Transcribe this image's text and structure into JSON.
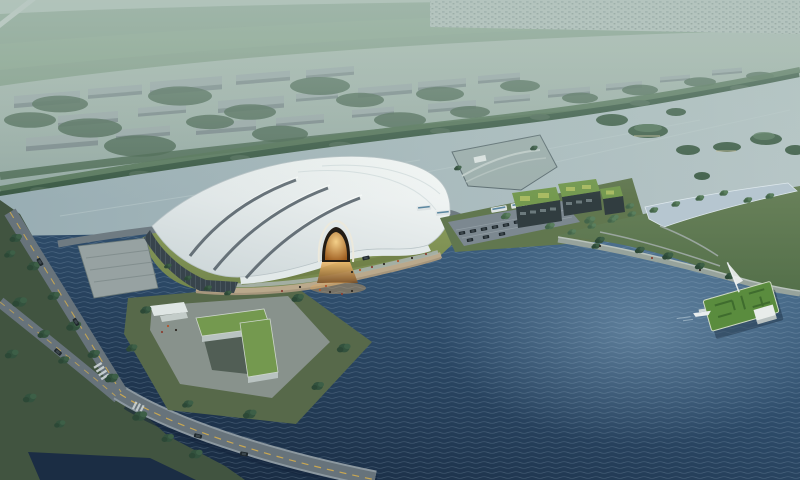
{
  "meta": {
    "kind": "architectural-aerial-rendering",
    "width": 800,
    "height": 480
  },
  "scene": {
    "description": "Aerial dusk rendering of a white membrane-roofed arena on a lakeside lawn island, with amber arched entrance, waterfront promenade, green-roof office cubes, parking lot, tree-lined boulevards with a bridge, a park peninsula with lawn pier, pavilion and yacht, a tree-lined river and hazy distant city",
    "landmarks": [
      "distant-cityscape",
      "riverfront-tree-avenue",
      "river",
      "river-islands",
      "arena",
      "arena-entrance-arch",
      "glazed-facade",
      "island-lawn",
      "waterfront-promenade",
      "moat",
      "office-cubes-green-roof",
      "parking-lot",
      "wedge-dock",
      "lakeside-park-peninsula",
      "reflecting-pool",
      "lawn-pier",
      "pavilion",
      "sail-mast",
      "yacht",
      "l-shaped-building",
      "drop-off-canopy",
      "boulevard",
      "bridge",
      "crosswalk",
      "lake",
      "cars",
      "buses",
      "trees",
      "pedestrians"
    ]
  },
  "palette": {
    "sky_top": "#b2c2b6",
    "sky_low": "#95aaa4",
    "field_green": "#7f9b84",
    "town_band": "#b9c4bf",
    "distant_roof": "#9dabab",
    "distant_face": "#7e8c8e",
    "tree_dark": "#33523e",
    "tree_mid": "#4e7152",
    "tree_far": "#4f6b57",
    "avenue_tree": "#3b5a45",
    "river": "#98adb3",
    "river_light": "#b7c6c7",
    "lake_light": "#4b7090",
    "lake_mid": "#2e4c6a",
    "lake_deep": "#15263c",
    "bank_green": "#415440",
    "lawn": "#87985a",
    "roof_white": "#f5f8f7",
    "roof_shade": "#ccd6d8",
    "roof_seam": "#505c64",
    "facade_glass": "#38444c",
    "wall_white": "#e2e9e9",
    "arch_dark": "#221c15",
    "arch_glow_in": "#ffd98f",
    "arch_glow_out": "#a35f1f",
    "steps": "#baa98c",
    "seawall": "#a6967c",
    "promenade": "#97a39c",
    "road": "#67737b",
    "road_line": "#c9a752",
    "plaza": "#8b958f",
    "dock": "#97a2a2",
    "parking": "#7c8890",
    "green_roof": "#74994f",
    "building_dark": "#313d40",
    "pool": "#b6c6d0",
    "pier_lawn": "#5a8c3e",
    "pavilion": "#e8ecea",
    "bus": "#dde3e4",
    "car_dark": "#1f282d",
    "people_red": "#b3552e",
    "haze": "#b0c4bd"
  }
}
